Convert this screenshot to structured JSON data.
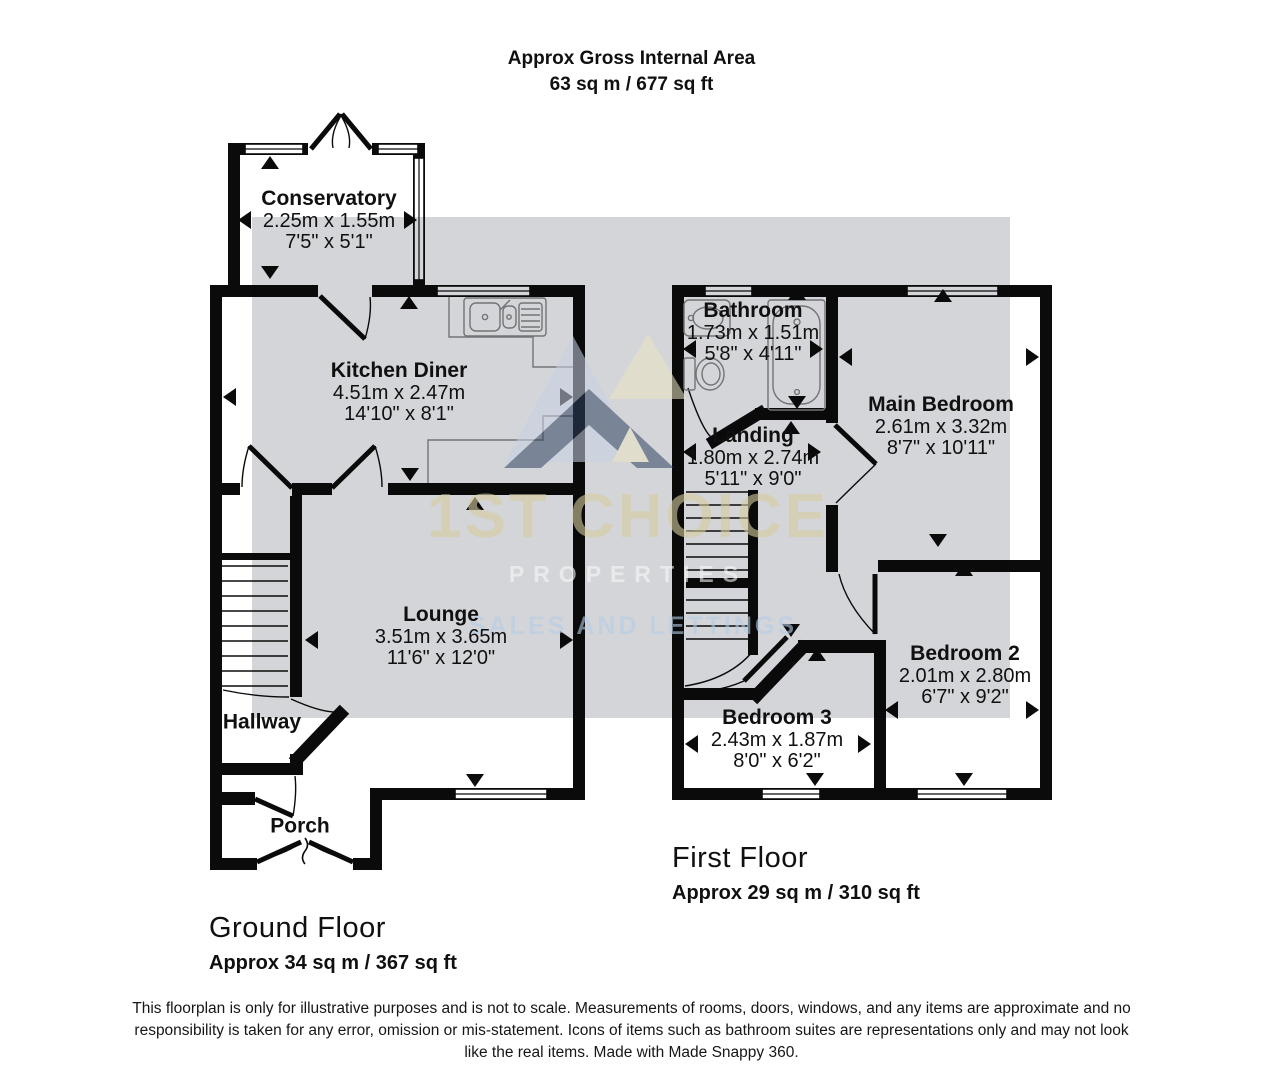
{
  "title": {
    "line1": "Approx Gross Internal Area",
    "line2": "63 sq m / 677 sq ft"
  },
  "floors": {
    "ground": {
      "label": "Ground Floor",
      "area": "Approx 34 sq m / 367 sq ft"
    },
    "first": {
      "label": "First Floor",
      "area": "Approx 29 sq m / 310 sq ft"
    }
  },
  "rooms": {
    "conservatory": {
      "name": "Conservatory",
      "metric": "2.25m x 1.55m",
      "imperial": "7'5\" x 5'1\""
    },
    "kitchen_diner": {
      "name": "Kitchen Diner",
      "metric": "4.51m x 2.47m",
      "imperial": "14'10\" x 8'1\""
    },
    "lounge": {
      "name": "Lounge",
      "metric": "3.51m x 3.65m",
      "imperial": "11'6\" x 12'0\""
    },
    "hallway": {
      "name": "Hallway"
    },
    "porch": {
      "name": "Porch"
    },
    "bathroom": {
      "name": "Bathroom",
      "metric": "1.73m x 1.51m",
      "imperial": "5'8\" x 4'11\""
    },
    "landing": {
      "name": "Landing",
      "metric": "1.80m x 2.74m",
      "imperial": "5'11\" x 9'0\""
    },
    "main_bedroom": {
      "name": "Main Bedroom",
      "metric": "2.61m x 3.32m",
      "imperial": "8'7\" x 10'11\""
    },
    "bedroom_2": {
      "name": "Bedroom 2",
      "metric": "2.01m x 2.80m",
      "imperial": "6'7\" x 9'2\""
    },
    "bedroom_3": {
      "name": "Bedroom 3",
      "metric": "2.43m x 1.87m",
      "imperial": "8'0\" x 6'2\""
    }
  },
  "watermark": {
    "brand": "1ST CHOICE",
    "tagline": "PROPERTIES",
    "subline": "SALES AND LETTINGS",
    "colors": {
      "overlay_gray": "#d4d5d9",
      "brand_text": "#d6cc9e",
      "tagline_text": "#f8f8f8",
      "subline_text": "#b5cde6",
      "logo_lavender": "#c9d1e4",
      "logo_cream": "#eae4c4",
      "logo_navy": "#2f4260"
    }
  },
  "disclaimer": {
    "text": "This floorplan is only for illustrative purposes and is not to scale. Measurements of rooms, doors, windows, and any items are approximate and no responsibility is taken for any error, omission or mis-statement. Icons of items such as bathroom suites are representations only and may not look like the real items. Made with Made Snappy 360."
  }
}
